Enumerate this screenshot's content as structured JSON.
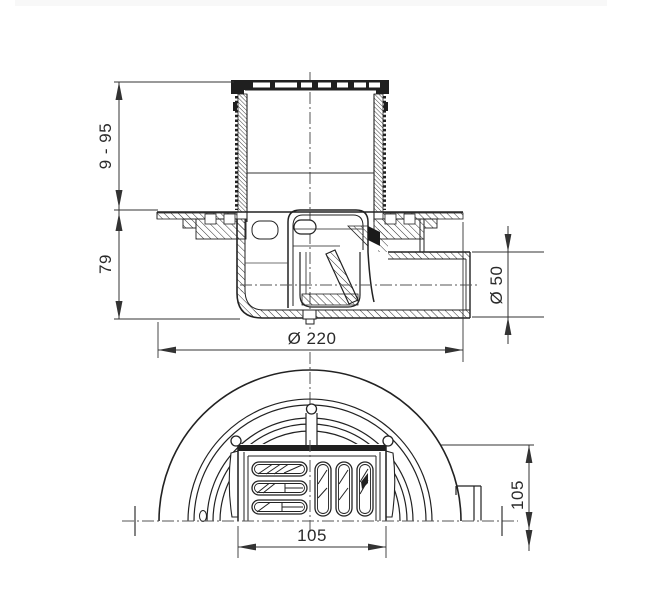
{
  "drawing": {
    "title": "Floor drain technical drawing",
    "line_color": "#222222",
    "centerline_color": "#555555",
    "views": [
      {
        "id": "section",
        "name": "front-section-view"
      },
      {
        "id": "plan",
        "name": "half-plan-view"
      }
    ],
    "dimensions": {
      "adjustable_height": "9 - 95",
      "body_height": "79",
      "flange_diameter": "Ø 220",
      "outlet_diameter": "Ø 50",
      "grate_width": "105",
      "grate_depth": "105"
    }
  }
}
